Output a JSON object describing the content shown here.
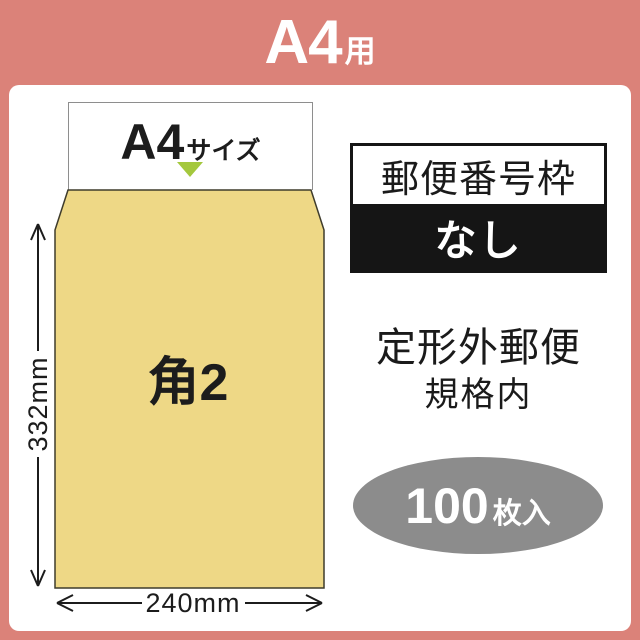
{
  "banner": {
    "title_main": "A4",
    "title_suffix": "用"
  },
  "envelope": {
    "paper_label_main": "A4",
    "paper_label_suffix": "サイズ",
    "body_label": "角2",
    "height_label": "332mm",
    "width_label": "240mm"
  },
  "info": {
    "postal_frame_title": "郵便番号枠",
    "postal_frame_value": "なし",
    "mail_type_line1": "定形外郵便",
    "mail_type_line2": "規格内",
    "count_number": "100",
    "count_suffix": "枚入"
  },
  "colors": {
    "frame_pink": "#db8279",
    "envelope_tan": "#eed886",
    "triangle_green": "#a4c83d",
    "badge_black": "#151515",
    "ellipse_gray": "#8c8c8c"
  }
}
